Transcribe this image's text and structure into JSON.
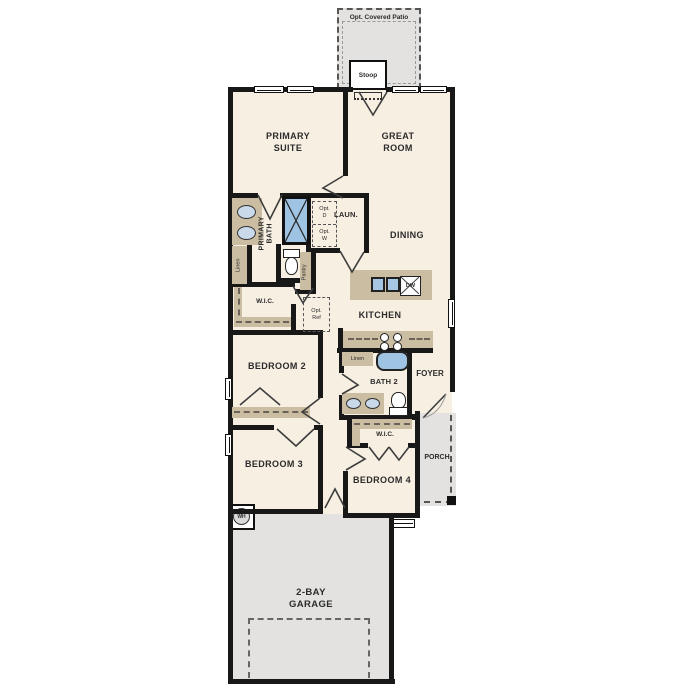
{
  "colors": {
    "floor": "#f7efe2",
    "casework_tan": "#cbbda1",
    "concrete_gray": "#e3e2e0",
    "fixture_blue": "#9fc3e2",
    "wall_black": "#181818",
    "text": "#2b2b2b"
  },
  "labels": {
    "patio": "Opt. Covered Patio",
    "stoop": "Stoop",
    "primary_suite": "PRIMARY\nSUITE",
    "great_room": "GREAT\nROOM",
    "primary_bath": "PRIMARY\nBATH",
    "linen_primary": "Linen",
    "laundry": "LAUN.",
    "opt_dryer": "Opt.\nD",
    "opt_washer": "Opt.\nW",
    "pantry": "Pantry",
    "dining": "DINING",
    "kitchen": "KITCHEN",
    "dishwasher": "DW",
    "wic_primary": "W.I.C.",
    "opt_fridge": "Opt.\nRef",
    "bedroom2": "BEDROOM 2",
    "linen_bath2": "Linen",
    "bath2": "BATH 2",
    "foyer": "FOYER",
    "bedroom3": "BEDROOM 3",
    "wic_bed4": "W.I.C.",
    "bedroom4": "BEDROOM 4",
    "porch": "PORCH",
    "water_heater": "WH",
    "garage": "2-BAY\nGARAGE"
  }
}
